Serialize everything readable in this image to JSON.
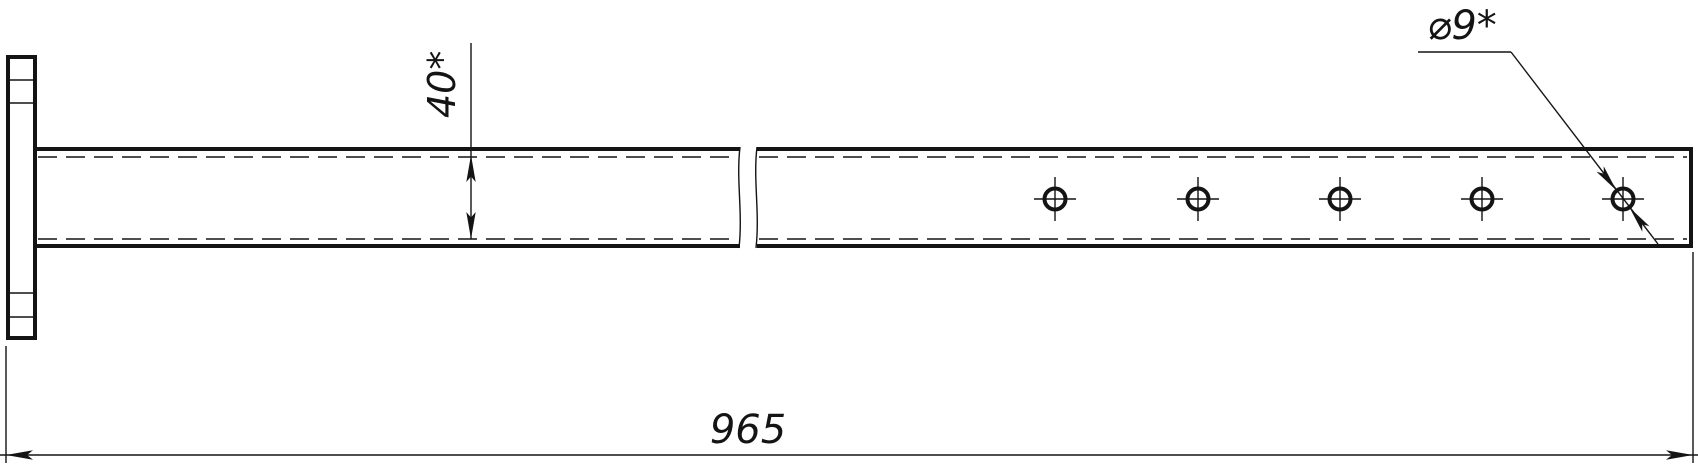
{
  "drawing": {
    "labels": {
      "bar_width": "40*",
      "overall_length": "965",
      "hole_diameter": "⌀9*"
    },
    "holes_count": 5,
    "colors": {
      "line": "#141414",
      "background": "#ffffff"
    }
  }
}
